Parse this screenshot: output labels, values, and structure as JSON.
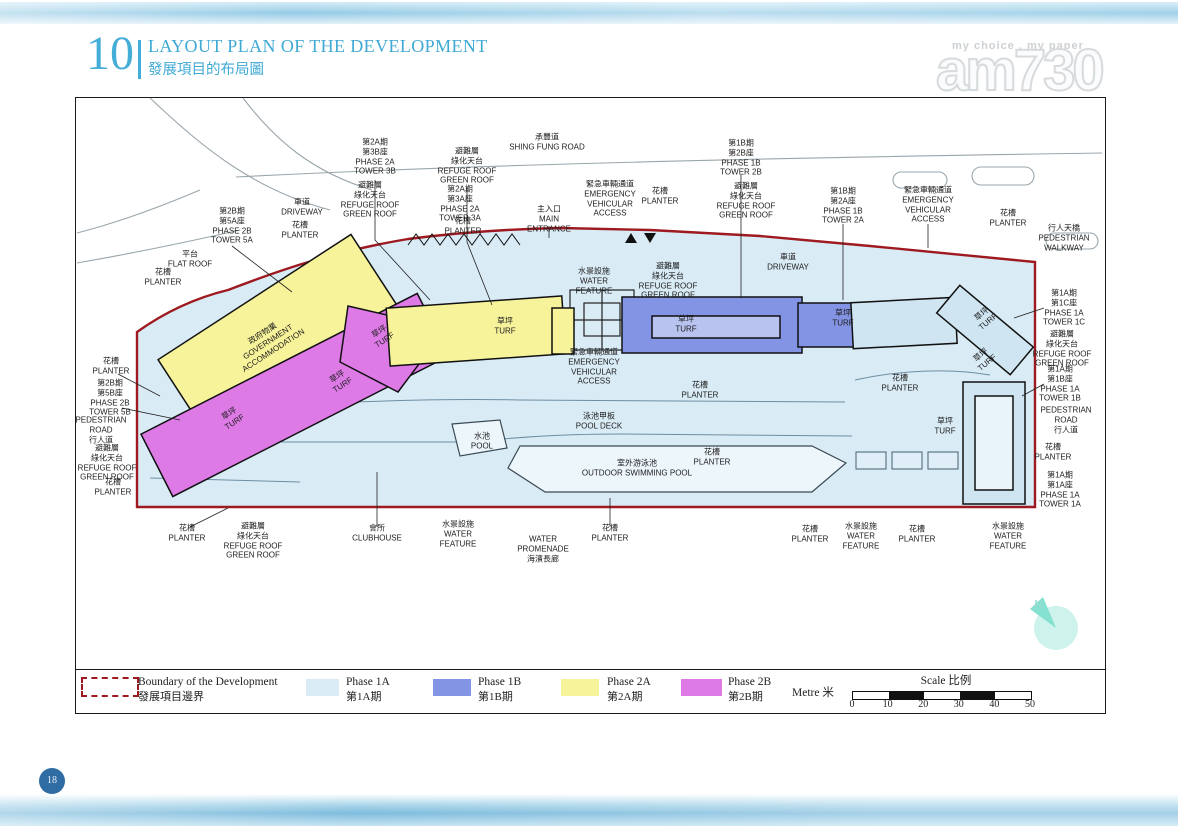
{
  "header": {
    "number": "10",
    "title": "LAYOUT PLAN OF THE DEVELOPMENT",
    "subtitle": "發展項目的布局圖"
  },
  "watermark": {
    "tagline": "my choice . my paper",
    "brand": "am730"
  },
  "page": {
    "number": "18"
  },
  "plan": {
    "compass_n": "N",
    "colors": {
      "boundary": "#9e1a20",
      "site": "#d9ebf5",
      "phase1a": "#cfe6f2",
      "phase1b": "#8494e4",
      "phase2a": "#f7f39b",
      "phase2b": "#dd7ae6"
    },
    "labels": [
      {
        "x": 375,
        "y": 157,
        "l": [
          "第2A期",
          "第3B座",
          "PHASE 2A",
          "TOWER 3B"
        ]
      },
      {
        "x": 467,
        "y": 166,
        "l": [
          "避難層",
          "綠化天台",
          "REFUGE ROOF",
          "GREEN ROOF"
        ]
      },
      {
        "x": 547,
        "y": 142,
        "l": [
          "承豐道",
          "SHING FUNG ROAD"
        ]
      },
      {
        "x": 741,
        "y": 158,
        "l": [
          "第1B期",
          "第2B座",
          "PHASE 1B",
          "TOWER 2B"
        ]
      },
      {
        "x": 302,
        "y": 207,
        "l": [
          "車道",
          "DRIVEWAY"
        ]
      },
      {
        "x": 370,
        "y": 200,
        "l": [
          "避難層",
          "綠化天台",
          "REFUGE ROOF",
          "GREEN ROOF"
        ]
      },
      {
        "x": 460,
        "y": 204,
        "l": [
          "第2A期",
          "第3A座",
          "PHASE 2A",
          "TOWER 3A"
        ]
      },
      {
        "x": 549,
        "y": 219,
        "l": [
          "主入口",
          "MAIN",
          "ENTRANCE"
        ]
      },
      {
        "x": 463,
        "y": 226,
        "l": [
          "花槽",
          "PLANTER"
        ]
      },
      {
        "x": 610,
        "y": 199,
        "l": [
          "緊急車輛通道",
          "EMERGENCY",
          "VEHICULAR",
          "ACCESS"
        ]
      },
      {
        "x": 660,
        "y": 196,
        "l": [
          "花槽",
          "PLANTER"
        ]
      },
      {
        "x": 746,
        "y": 201,
        "l": [
          "避難層",
          "綠化天台",
          "REFUGE ROOF",
          "GREEN ROOF"
        ]
      },
      {
        "x": 843,
        "y": 206,
        "l": [
          "第1B期",
          "第2A座",
          "PHASE 1B",
          "TOWER 2A"
        ]
      },
      {
        "x": 928,
        "y": 205,
        "l": [
          "緊急車輛通道",
          "EMERGENCY",
          "VEHICULAR",
          "ACCESS"
        ]
      },
      {
        "x": 1008,
        "y": 218,
        "l": [
          "花槽",
          "PLANTER"
        ]
      },
      {
        "x": 1064,
        "y": 238,
        "l": [
          "行人天橋",
          "PEDESTRIAN",
          "WALKWAY"
        ]
      },
      {
        "x": 788,
        "y": 262,
        "l": [
          "車道",
          "DRIVEWAY"
        ]
      },
      {
        "x": 232,
        "y": 226,
        "l": [
          "第2B期",
          "第5A座",
          "PHASE 2B",
          "TOWER 5A"
        ]
      },
      {
        "x": 300,
        "y": 230,
        "l": [
          "花槽",
          "PLANTER"
        ]
      },
      {
        "x": 190,
        "y": 259,
        "l": [
          "平台",
          "FLAT ROOF"
        ]
      },
      {
        "x": 163,
        "y": 277,
        "l": [
          "花槽",
          "PLANTER"
        ]
      },
      {
        "x": 111,
        "y": 366,
        "l": [
          "花槽",
          "PLANTER"
        ]
      },
      {
        "x": 110,
        "y": 398,
        "l": [
          "第2B期",
          "第5B座",
          "PHASE 2B",
          "TOWER 5B"
        ]
      },
      {
        "x": 101,
        "y": 430,
        "l": [
          "PEDESTRIAN",
          "ROAD",
          "行人道"
        ]
      },
      {
        "x": 107,
        "y": 463,
        "l": [
          "避難層",
          "綠化天台",
          "REFUGE ROOF",
          "GREEN ROOF"
        ]
      },
      {
        "x": 113,
        "y": 487,
        "l": [
          "花槽",
          "PLANTER"
        ]
      },
      {
        "x": 1064,
        "y": 308,
        "l": [
          "第1A期",
          "第1C座",
          "PHASE 1A",
          "TOWER 1C"
        ]
      },
      {
        "x": 1062,
        "y": 349,
        "l": [
          "避難層",
          "綠化天台",
          "REFUGE ROOF",
          "GREEN ROOF"
        ]
      },
      {
        "x": 1060,
        "y": 384,
        "l": [
          "第1A期",
          "第1B座",
          "PHASE 1A",
          "TOWER 1B"
        ]
      },
      {
        "x": 1066,
        "y": 420,
        "l": [
          "PEDESTRIAN",
          "ROAD",
          "行人道"
        ]
      },
      {
        "x": 1053,
        "y": 452,
        "l": [
          "花槽",
          "PLANTER"
        ]
      },
      {
        "x": 1060,
        "y": 490,
        "l": [
          "第1A期",
          "第1A座",
          "PHASE 1A",
          "TOWER 1A"
        ]
      },
      {
        "x": 187,
        "y": 533,
        "l": [
          "花槽",
          "PLANTER"
        ]
      },
      {
        "x": 253,
        "y": 541,
        "l": [
          "避難層",
          "綠化天台",
          "REFUGE ROOF",
          "GREEN ROOF"
        ]
      },
      {
        "x": 377,
        "y": 533,
        "l": [
          "會所",
          "CLUBHOUSE"
        ]
      },
      {
        "x": 458,
        "y": 534,
        "l": [
          "水景設施",
          "WATER",
          "FEATURE"
        ]
      },
      {
        "x": 543,
        "y": 549,
        "l": [
          "WATER",
          "PROMENADE",
          "海濱長廊"
        ]
      },
      {
        "x": 610,
        "y": 533,
        "l": [
          "花槽",
          "PLANTER"
        ]
      },
      {
        "x": 810,
        "y": 534,
        "l": [
          "花槽",
          "PLANTER"
        ]
      },
      {
        "x": 861,
        "y": 536,
        "l": [
          "水景設施",
          "WATER",
          "FEATURE"
        ]
      },
      {
        "x": 917,
        "y": 534,
        "l": [
          "花槽",
          "PLANTER"
        ]
      },
      {
        "x": 1008,
        "y": 536,
        "l": [
          "水景設施",
          "WATER",
          "FEATURE"
        ]
      },
      {
        "x": 594,
        "y": 281,
        "l": [
          "水景設施",
          "WATER",
          "FEATURE"
        ]
      },
      {
        "x": 668,
        "y": 281,
        "l": [
          "避難層",
          "綠化天台",
          "REFUGE ROOF",
          "GREEN ROOF"
        ]
      },
      {
        "x": 686,
        "y": 324,
        "l": [
          "草坪",
          "TURF"
        ]
      },
      {
        "x": 594,
        "y": 367,
        "l": [
          "緊急車輛通道",
          "EMERGENCY",
          "VEHICULAR",
          "ACCESS"
        ]
      },
      {
        "x": 700,
        "y": 390,
        "l": [
          "花槽",
          "PLANTER"
        ]
      },
      {
        "x": 599,
        "y": 421,
        "l": [
          "泳池甲板",
          "POOL DECK"
        ]
      },
      {
        "x": 482,
        "y": 441,
        "l": [
          "水池",
          "POOL"
        ]
      },
      {
        "x": 637,
        "y": 468,
        "l": [
          "室外游泳池",
          "OUTDOOR SWIMMING POOL"
        ]
      },
      {
        "x": 712,
        "y": 457,
        "l": [
          "花槽",
          "PLANTER"
        ]
      },
      {
        "x": 268,
        "y": 342,
        "rot": -33,
        "l": [
          "政府物業",
          "GOVERNMENT",
          "ACCOMMODATION"
        ]
      },
      {
        "x": 505,
        "y": 326,
        "l": [
          "草坪",
          "TURF"
        ]
      },
      {
        "x": 382,
        "y": 336,
        "rot": -33,
        "l": [
          "草坪",
          "TURF"
        ]
      },
      {
        "x": 340,
        "y": 381,
        "rot": -33,
        "l": [
          "草坪",
          "TURF"
        ]
      },
      {
        "x": 232,
        "y": 418,
        "rot": -33,
        "l": [
          "草坪",
          "TURF"
        ]
      },
      {
        "x": 843,
        "y": 318,
        "l": [
          "草坪",
          "TURF"
        ]
      },
      {
        "x": 985,
        "y": 318,
        "rot": -40,
        "l": [
          "草坪",
          "TURF"
        ]
      },
      {
        "x": 984,
        "y": 359,
        "rot": -40,
        "l": [
          "草坪",
          "TURF"
        ]
      },
      {
        "x": 900,
        "y": 383,
        "l": [
          "花槽",
          "PLANTER"
        ]
      },
      {
        "x": 945,
        "y": 426,
        "l": [
          "草坪",
          "TURF"
        ]
      }
    ]
  },
  "legend": {
    "boundary": {
      "en": "Boundary of the Development",
      "zh": "發展項目邊界"
    },
    "phases": [
      {
        "en": "Phase 1A",
        "zh": "第1A期",
        "color": "#d9ebf5"
      },
      {
        "en": "Phase 1B",
        "zh": "第1B期",
        "color": "#8494e4"
      },
      {
        "en": "Phase 2A",
        "zh": "第2A期",
        "color": "#f7f39b"
      },
      {
        "en": "Phase 2B",
        "zh": "第2B期",
        "color": "#dd7ae6"
      }
    ]
  },
  "scale": {
    "metre": "Metre 米",
    "title": "Scale 比例",
    "ticks": [
      "0",
      "10",
      "20",
      "30",
      "40",
      "50"
    ]
  }
}
